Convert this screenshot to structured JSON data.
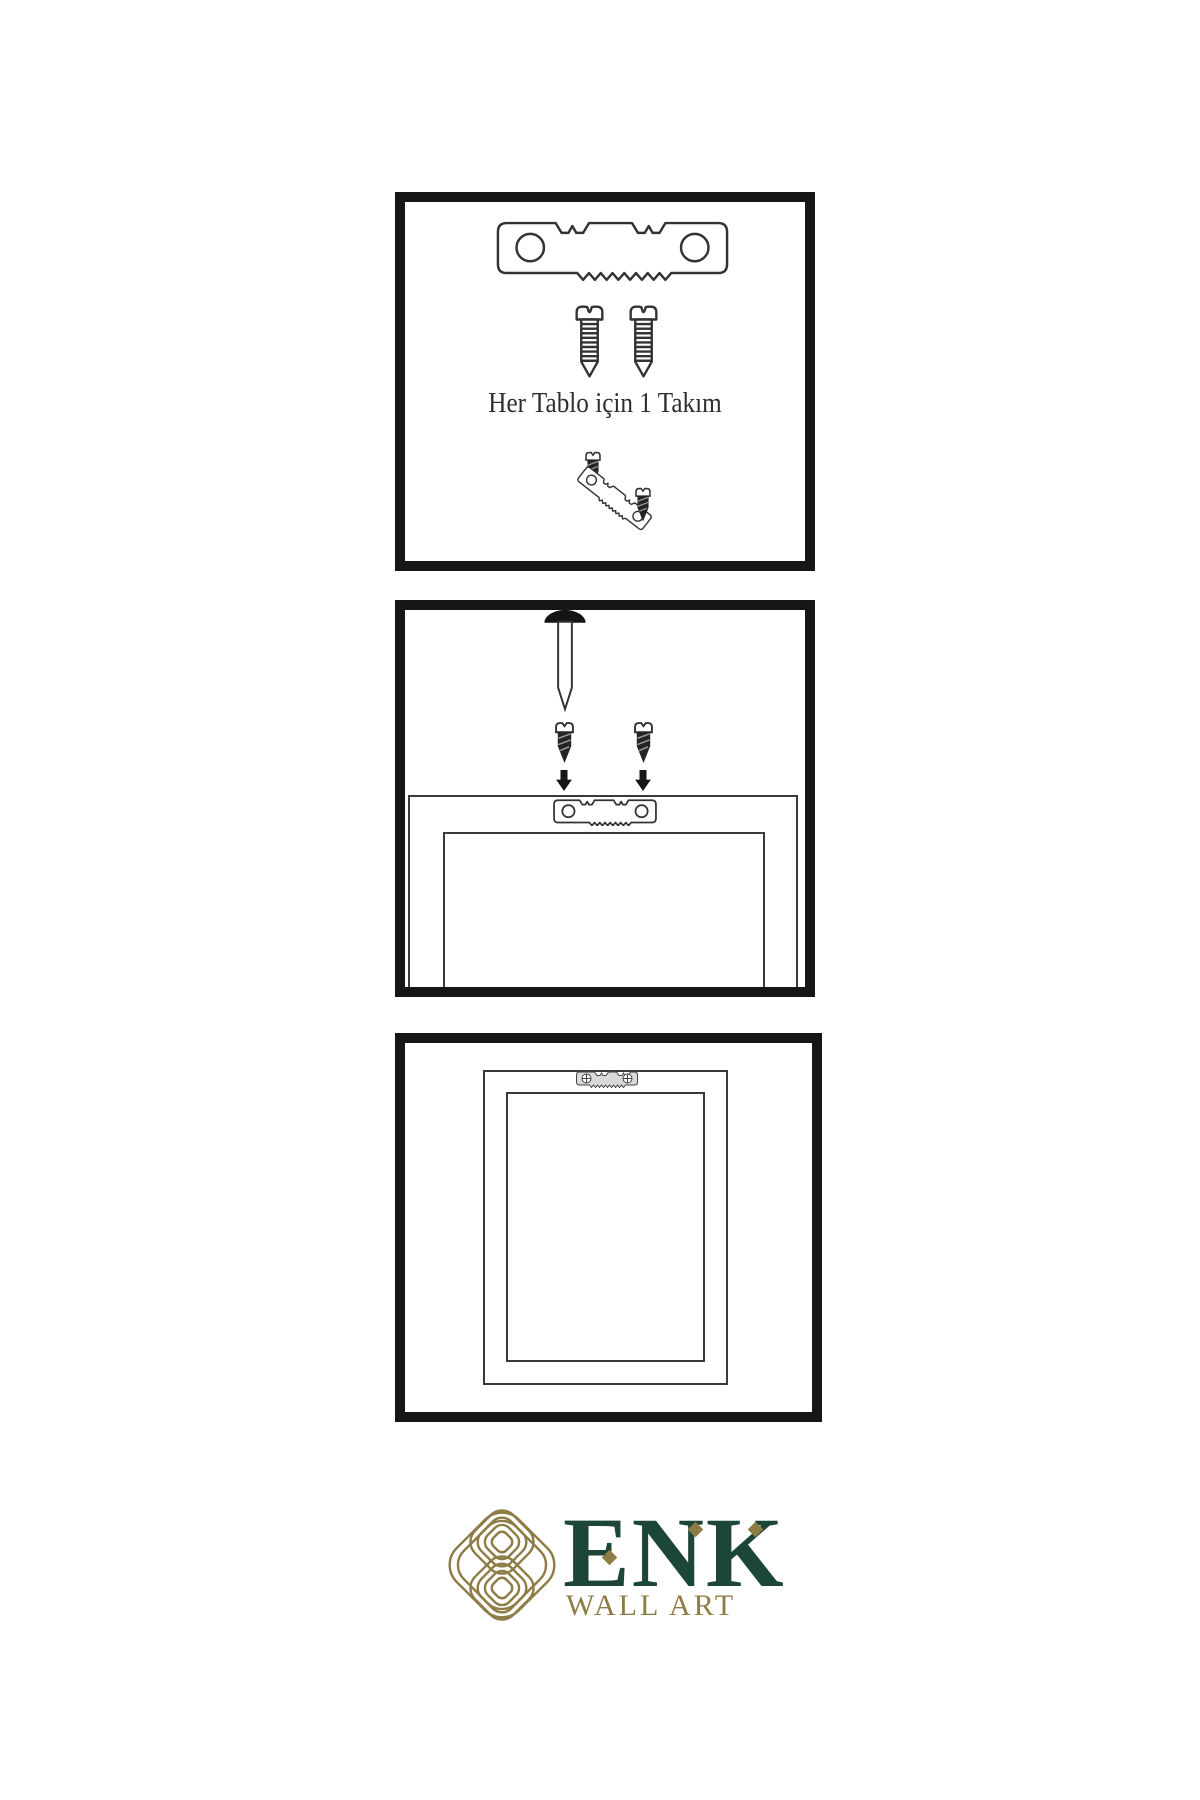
{
  "page": {
    "width": 1200,
    "height": 1800,
    "background": "#ffffff"
  },
  "panel_kit": {
    "caption": "Her Tablo için 1 Takım",
    "contents": [
      "sawtooth-hanger-bracket",
      "mounting-screw",
      "mounting-screw",
      "demo-screw",
      "tilted-sawtooth-hanger",
      "demo-screw"
    ]
  },
  "panel_wall": {
    "contents": [
      "wall-nail",
      "dark-screw",
      "dark-screw",
      "down-arrow",
      "down-arrow",
      "frame-back-with-hanger"
    ]
  },
  "panel_hung": {
    "contents": [
      "hung-frame-back",
      "mounted-sawtooth-hanger"
    ]
  },
  "logo": {
    "brand": "ENK",
    "subtitle": "WALL ART"
  },
  "colors": {
    "panel_border": "#161616",
    "line_art": "#333333",
    "dark_hardware": "#242424",
    "mounted_bracket_fill": "#d9d9d9",
    "logo_green": "#1c4636",
    "logo_gold": "#8e7c45"
  },
  "icons": {
    "sawtooth_hanger": "sawtooth-hanger-icon",
    "screw_light": "screw-icon",
    "screw_dark": "dark-screw-icon",
    "nail": "wall-nail-icon",
    "arrow": "down-arrow-icon",
    "knot": "knot-logo-icon",
    "diamond": "diamond-accent-icon"
  }
}
